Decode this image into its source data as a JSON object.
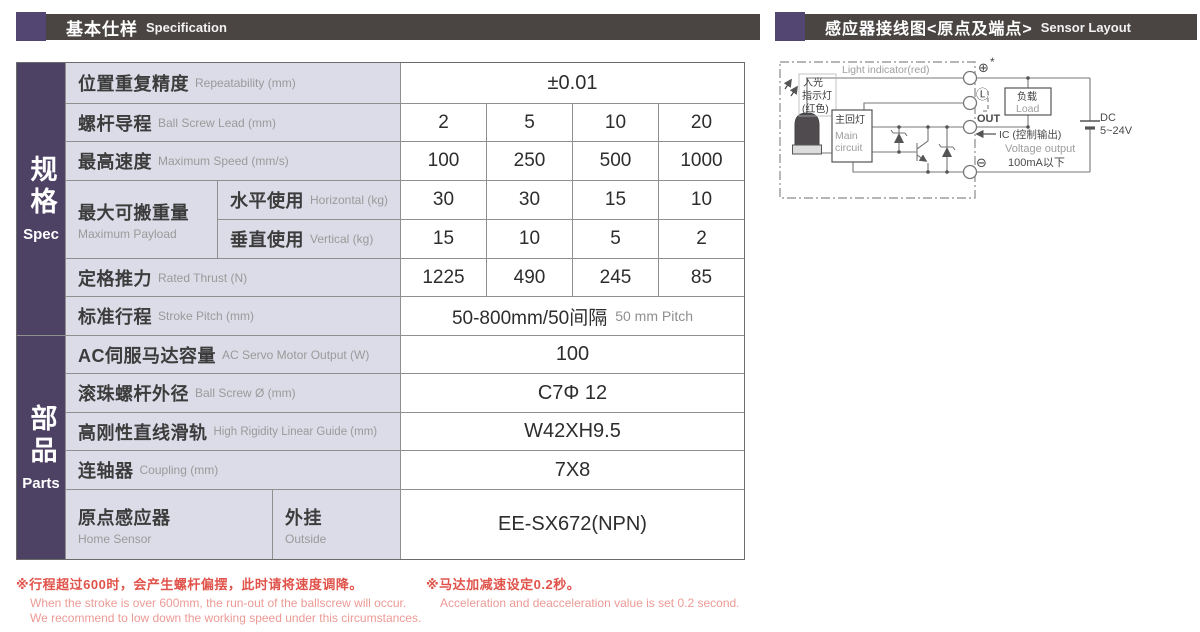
{
  "header_left": {
    "title_zh": "基本仕样",
    "title_en": "Specification"
  },
  "header_right": {
    "title_zh": "感应器接线图<原点及端点>",
    "title_en": "Sensor Layout"
  },
  "table": {
    "sections": {
      "spec": {
        "zh": "规格",
        "en": "Spec"
      },
      "parts": {
        "zh": "部品",
        "en": "Parts"
      }
    },
    "rows": {
      "repeatability": {
        "zh": "位置重复精度",
        "en": "Repeatability (mm)",
        "value": "±0.01"
      },
      "ball_screw_lead": {
        "zh": "螺杆导程",
        "en": "Ball Screw Lead (mm)",
        "values": [
          "2",
          "5",
          "10",
          "20"
        ]
      },
      "max_speed": {
        "zh": "最高速度",
        "en": "Maximum Speed (mm/s)",
        "values": [
          "100",
          "250",
          "500",
          "1000"
        ]
      },
      "max_payload": {
        "zh": "最大可搬重量",
        "en": "Maximum Payload",
        "horizontal": {
          "zh": "水平使用",
          "en": "Horizontal (kg)",
          "values": [
            "30",
            "30",
            "15",
            "10"
          ]
        },
        "vertical": {
          "zh": "垂直使用",
          "en": "Vertical (kg)",
          "values": [
            "15",
            "10",
            "5",
            "2"
          ]
        }
      },
      "rated_thrust": {
        "zh": "定格推力",
        "en": "Rated Thrust (N)",
        "values": [
          "1225",
          "490",
          "245",
          "85"
        ]
      },
      "stroke_pitch": {
        "zh": "标准行程",
        "en": "Stroke Pitch (mm)",
        "value_zh": "50-800mm/50间隔",
        "value_en": "50 mm Pitch"
      },
      "servo_output": {
        "zh": "AC伺服马达容量",
        "en": "AC Servo Motor Output (W)",
        "value": "100"
      },
      "ball_screw_dia": {
        "zh": "滚珠螺杆外径",
        "en": "Ball Screw Ø (mm)",
        "value": "C7Φ 12"
      },
      "linear_guide": {
        "zh": "高刚性直线滑轨",
        "en": "High Rigidity Linear Guide (mm)",
        "value": "W42XH9.5"
      },
      "coupling": {
        "zh": "连轴器",
        "en": "Coupling (mm)",
        "value": "7X8"
      },
      "home_sensor": {
        "zh": "原点感应器",
        "en": "Home Sensor",
        "mount_zh": "外挂",
        "mount_en": "Outside",
        "value": "EE-SX672(NPN)"
      }
    }
  },
  "footnotes": {
    "stroke": {
      "zh": "※行程超过600时，会产生螺杆偏摆，此时请将速度调降。",
      "en1": "When the stroke is over 600mm, the run-out of the ballscrew will occur.",
      "en2": "We recommend to low down the working speed under this circumstances."
    },
    "accel": {
      "zh": "※马达加减速设定0.2秒。",
      "en": "Acceleration and deacceleration value is set 0.2 second."
    }
  },
  "diagram": {
    "light_indicator_en": "Light indicator(red)",
    "light_in_zh": "入光",
    "indicator_zh": "指示灯",
    "red_zh": "(红色)",
    "main_circuit_zh": "主回灯",
    "main_circuit_en1": "Main",
    "main_circuit_en2": "circuit",
    "terminal_plus": "⊕",
    "terminal_star": "*",
    "terminal_l": "Ⓛ",
    "terminal_out": "OUT",
    "terminal_minus": "⊖",
    "load_zh": "负载",
    "load_en": "Load",
    "ic_label": "IC (控制输出)",
    "voltage_output_en": "Voltage output",
    "current_limit": "100mA以下",
    "dc_label": "DC",
    "dc_range": "5~24V"
  },
  "colors": {
    "accent_purple": "#4d4164",
    "header_bar": "#4a4543",
    "label_bg": "#dcdce8",
    "footnote_red": "#e0534b"
  }
}
